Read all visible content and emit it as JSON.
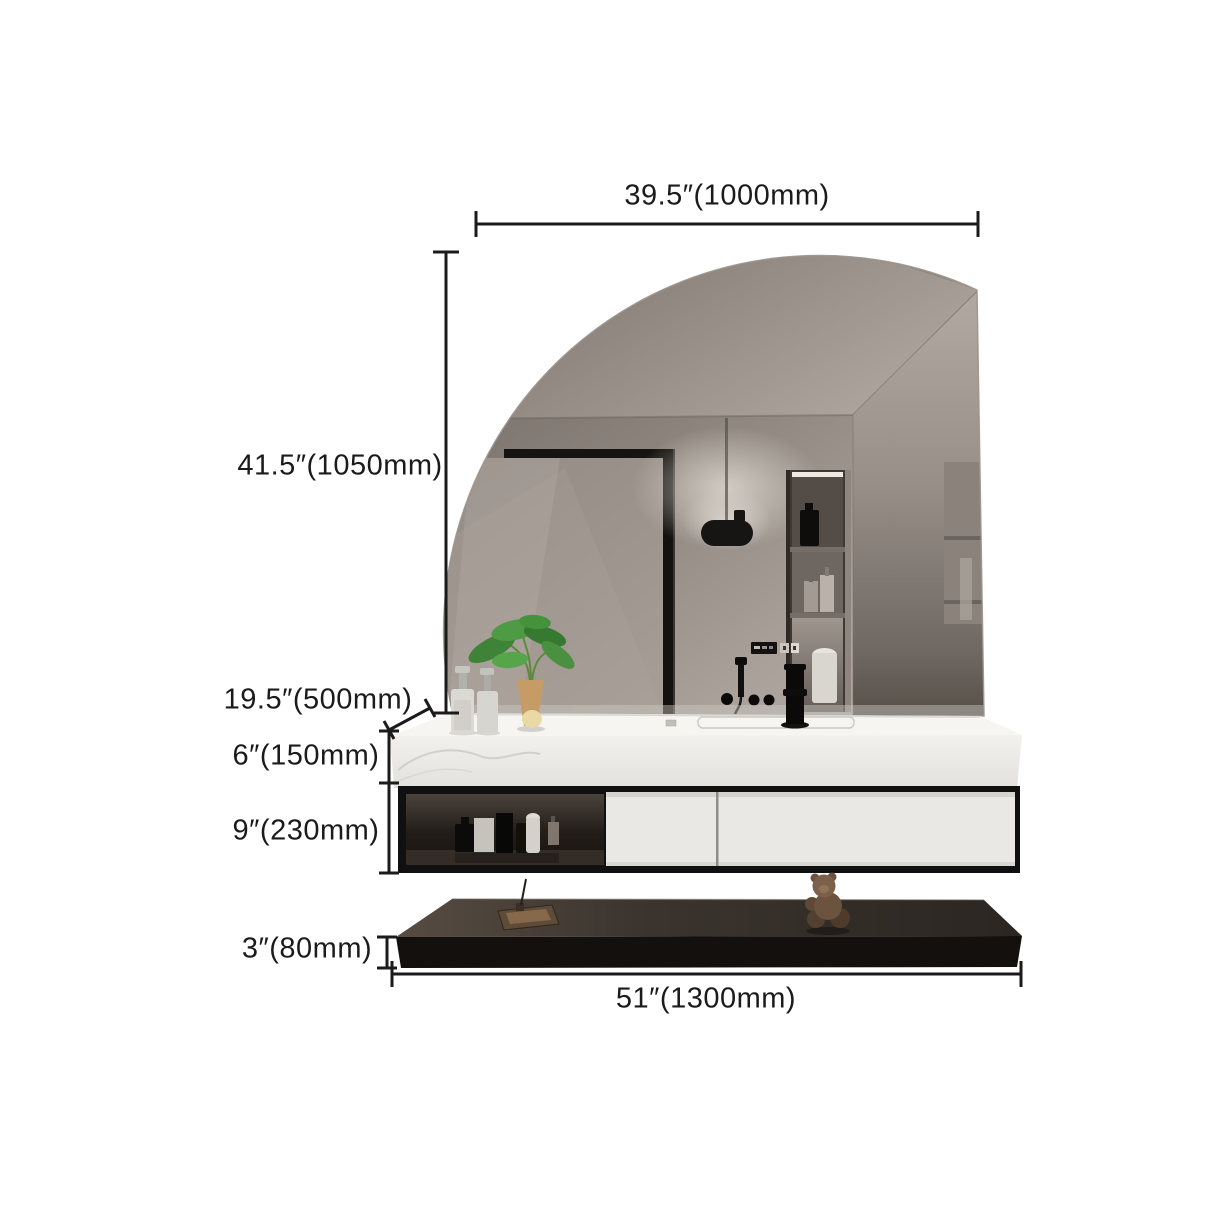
{
  "page": {
    "type": "product-dimension-diagram",
    "background": "#ffffff"
  },
  "annotations": {
    "line_color": "#1b1b1b",
    "labels": {
      "mirror_width": "39.5″(1000mm)",
      "mirror_height": "41.5″(1050mm)",
      "counter_depth": "19.5″(500mm)",
      "countertop_height": "6″(150mm)",
      "cabinet_height": "9″(230mm)",
      "shelf_thickness": "3″(80mm)",
      "total_width": "51″(1300mm)"
    }
  },
  "scene": {
    "subject": "wall-hung bathroom vanity with quarter-round mirror, stone countertop, black-framed cabinet with open shelf and two white drawers, and floating black display shelf",
    "colors": {
      "mirror_reflection": "#968e87",
      "ceiling": "#9a938c",
      "countertop": "#f4f3f0",
      "cabinet_frame": "#111010",
      "drawer_front": "#e9e8e4",
      "floating_shelf": "#14100d",
      "plant_leaves": "#4f9a45",
      "vase": "#c59c66",
      "teddy": "#6b5340"
    }
  }
}
